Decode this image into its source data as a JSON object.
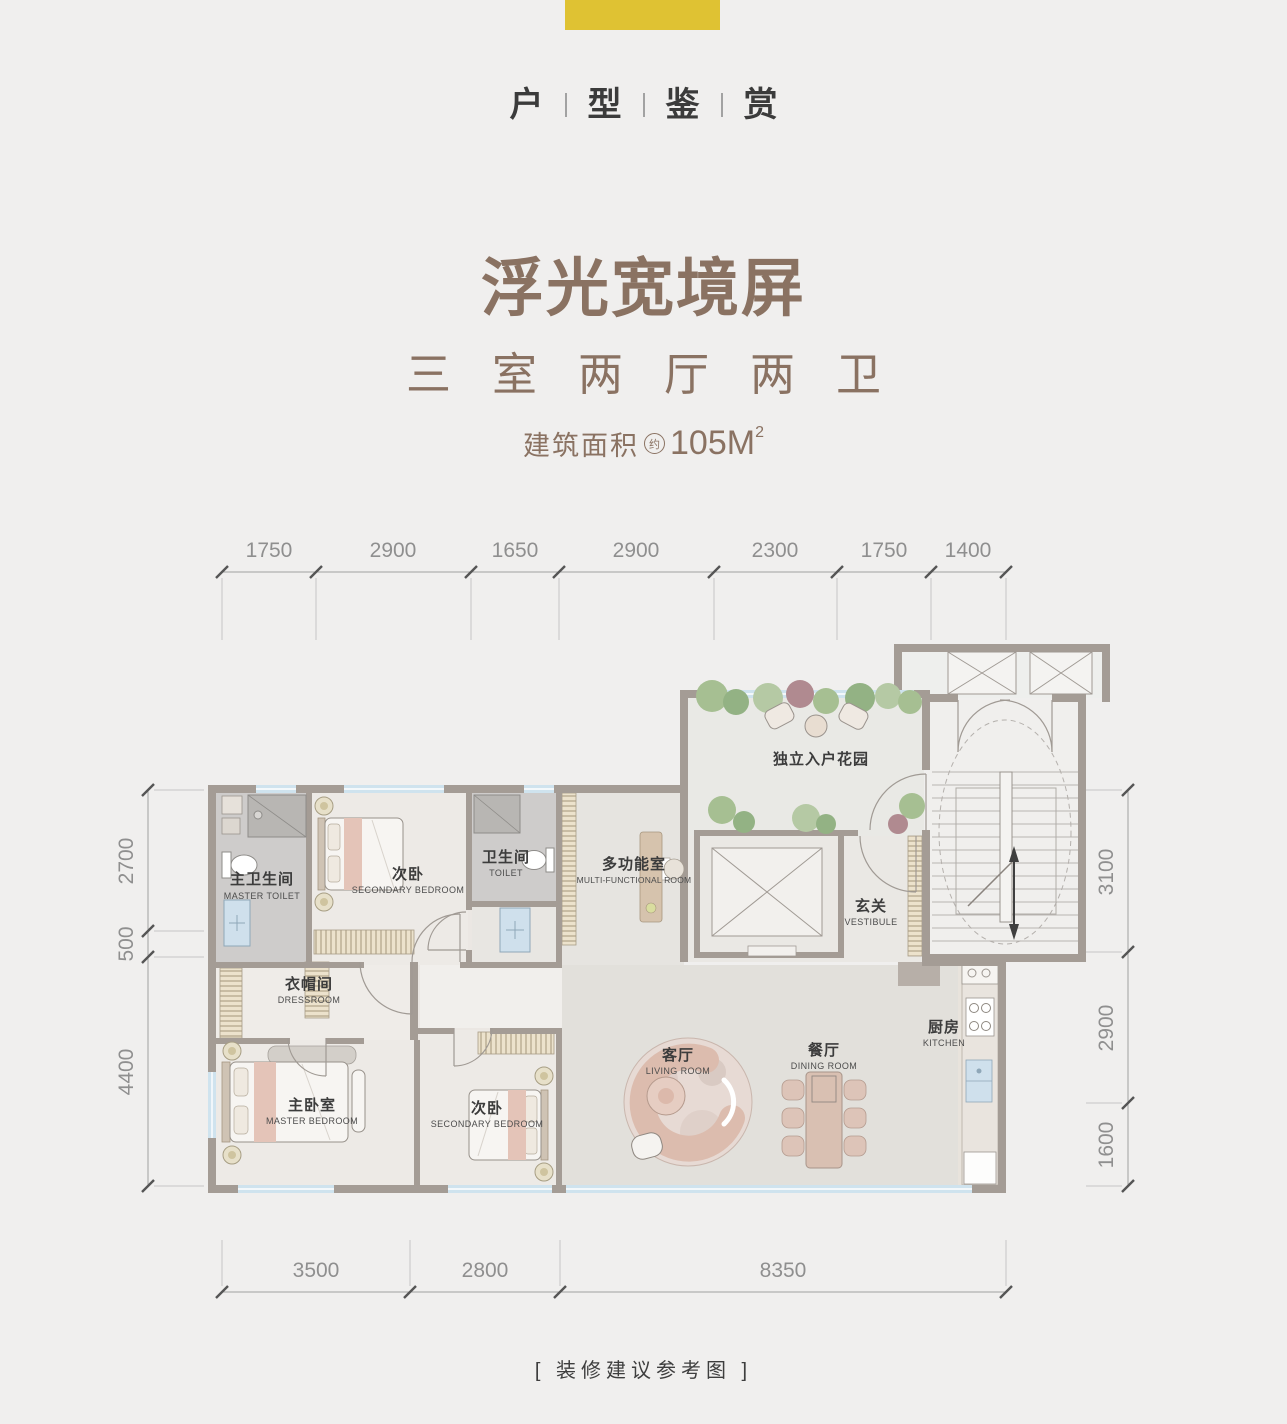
{
  "page": {
    "background": "#f0efee",
    "accent_yellow": "#dfc233",
    "accent_brown": "#8a7262"
  },
  "header": {
    "chars": [
      "户",
      "型",
      "鉴",
      "赏"
    ]
  },
  "hero": {
    "title": "浮光宽境屏",
    "subtitle_chars": [
      "三",
      "室",
      "两",
      "厅",
      "两",
      "卫"
    ],
    "area_label": "建筑面积",
    "area_approx": "约",
    "area_value": "105M",
    "area_sup": "2"
  },
  "plan": {
    "dims": {
      "top": [
        "1750",
        "2900",
        "1650",
        "2900",
        "2300",
        "1750",
        "1400"
      ],
      "bottom": [
        "3500",
        "2800",
        "8350"
      ],
      "left": [
        "2700",
        "500",
        "4400"
      ],
      "right": [
        "3100",
        "2900",
        "1600"
      ]
    },
    "rooms": {
      "master_toilet": {
        "cn": "主卫生间",
        "en": "MASTER TOILET"
      },
      "secondary_bedroom_top": {
        "cn": "次卧",
        "en": "SECONDARY BEDROOM"
      },
      "toilet": {
        "cn": "卫生间",
        "en": "TOILET"
      },
      "multi_functional_room": {
        "cn": "多功能室",
        "en": "MULTI-FUNCTIONAL ROOM"
      },
      "entry_garden": {
        "cn": "独立入户花园"
      },
      "vestibule": {
        "cn": "玄关",
        "en": "VESTIBULE"
      },
      "dressroom": {
        "cn": "衣帽间",
        "en": "DRESSROOM"
      },
      "master_bedroom": {
        "cn": "主卧室",
        "en": "MASTER BEDROOM"
      },
      "secondary_bedroom_bottom": {
        "cn": "次卧",
        "en": "SECONDARY BEDROOM"
      },
      "living_room": {
        "cn": "客厅",
        "en": "LIVING ROOM"
      },
      "dining_room": {
        "cn": "餐厅",
        "en": "DINING ROOM"
      },
      "kitchen": {
        "cn": "厨房",
        "en": "KITCHEN"
      }
    }
  },
  "footer": {
    "note": "[ 装修建议参考图 ]"
  }
}
